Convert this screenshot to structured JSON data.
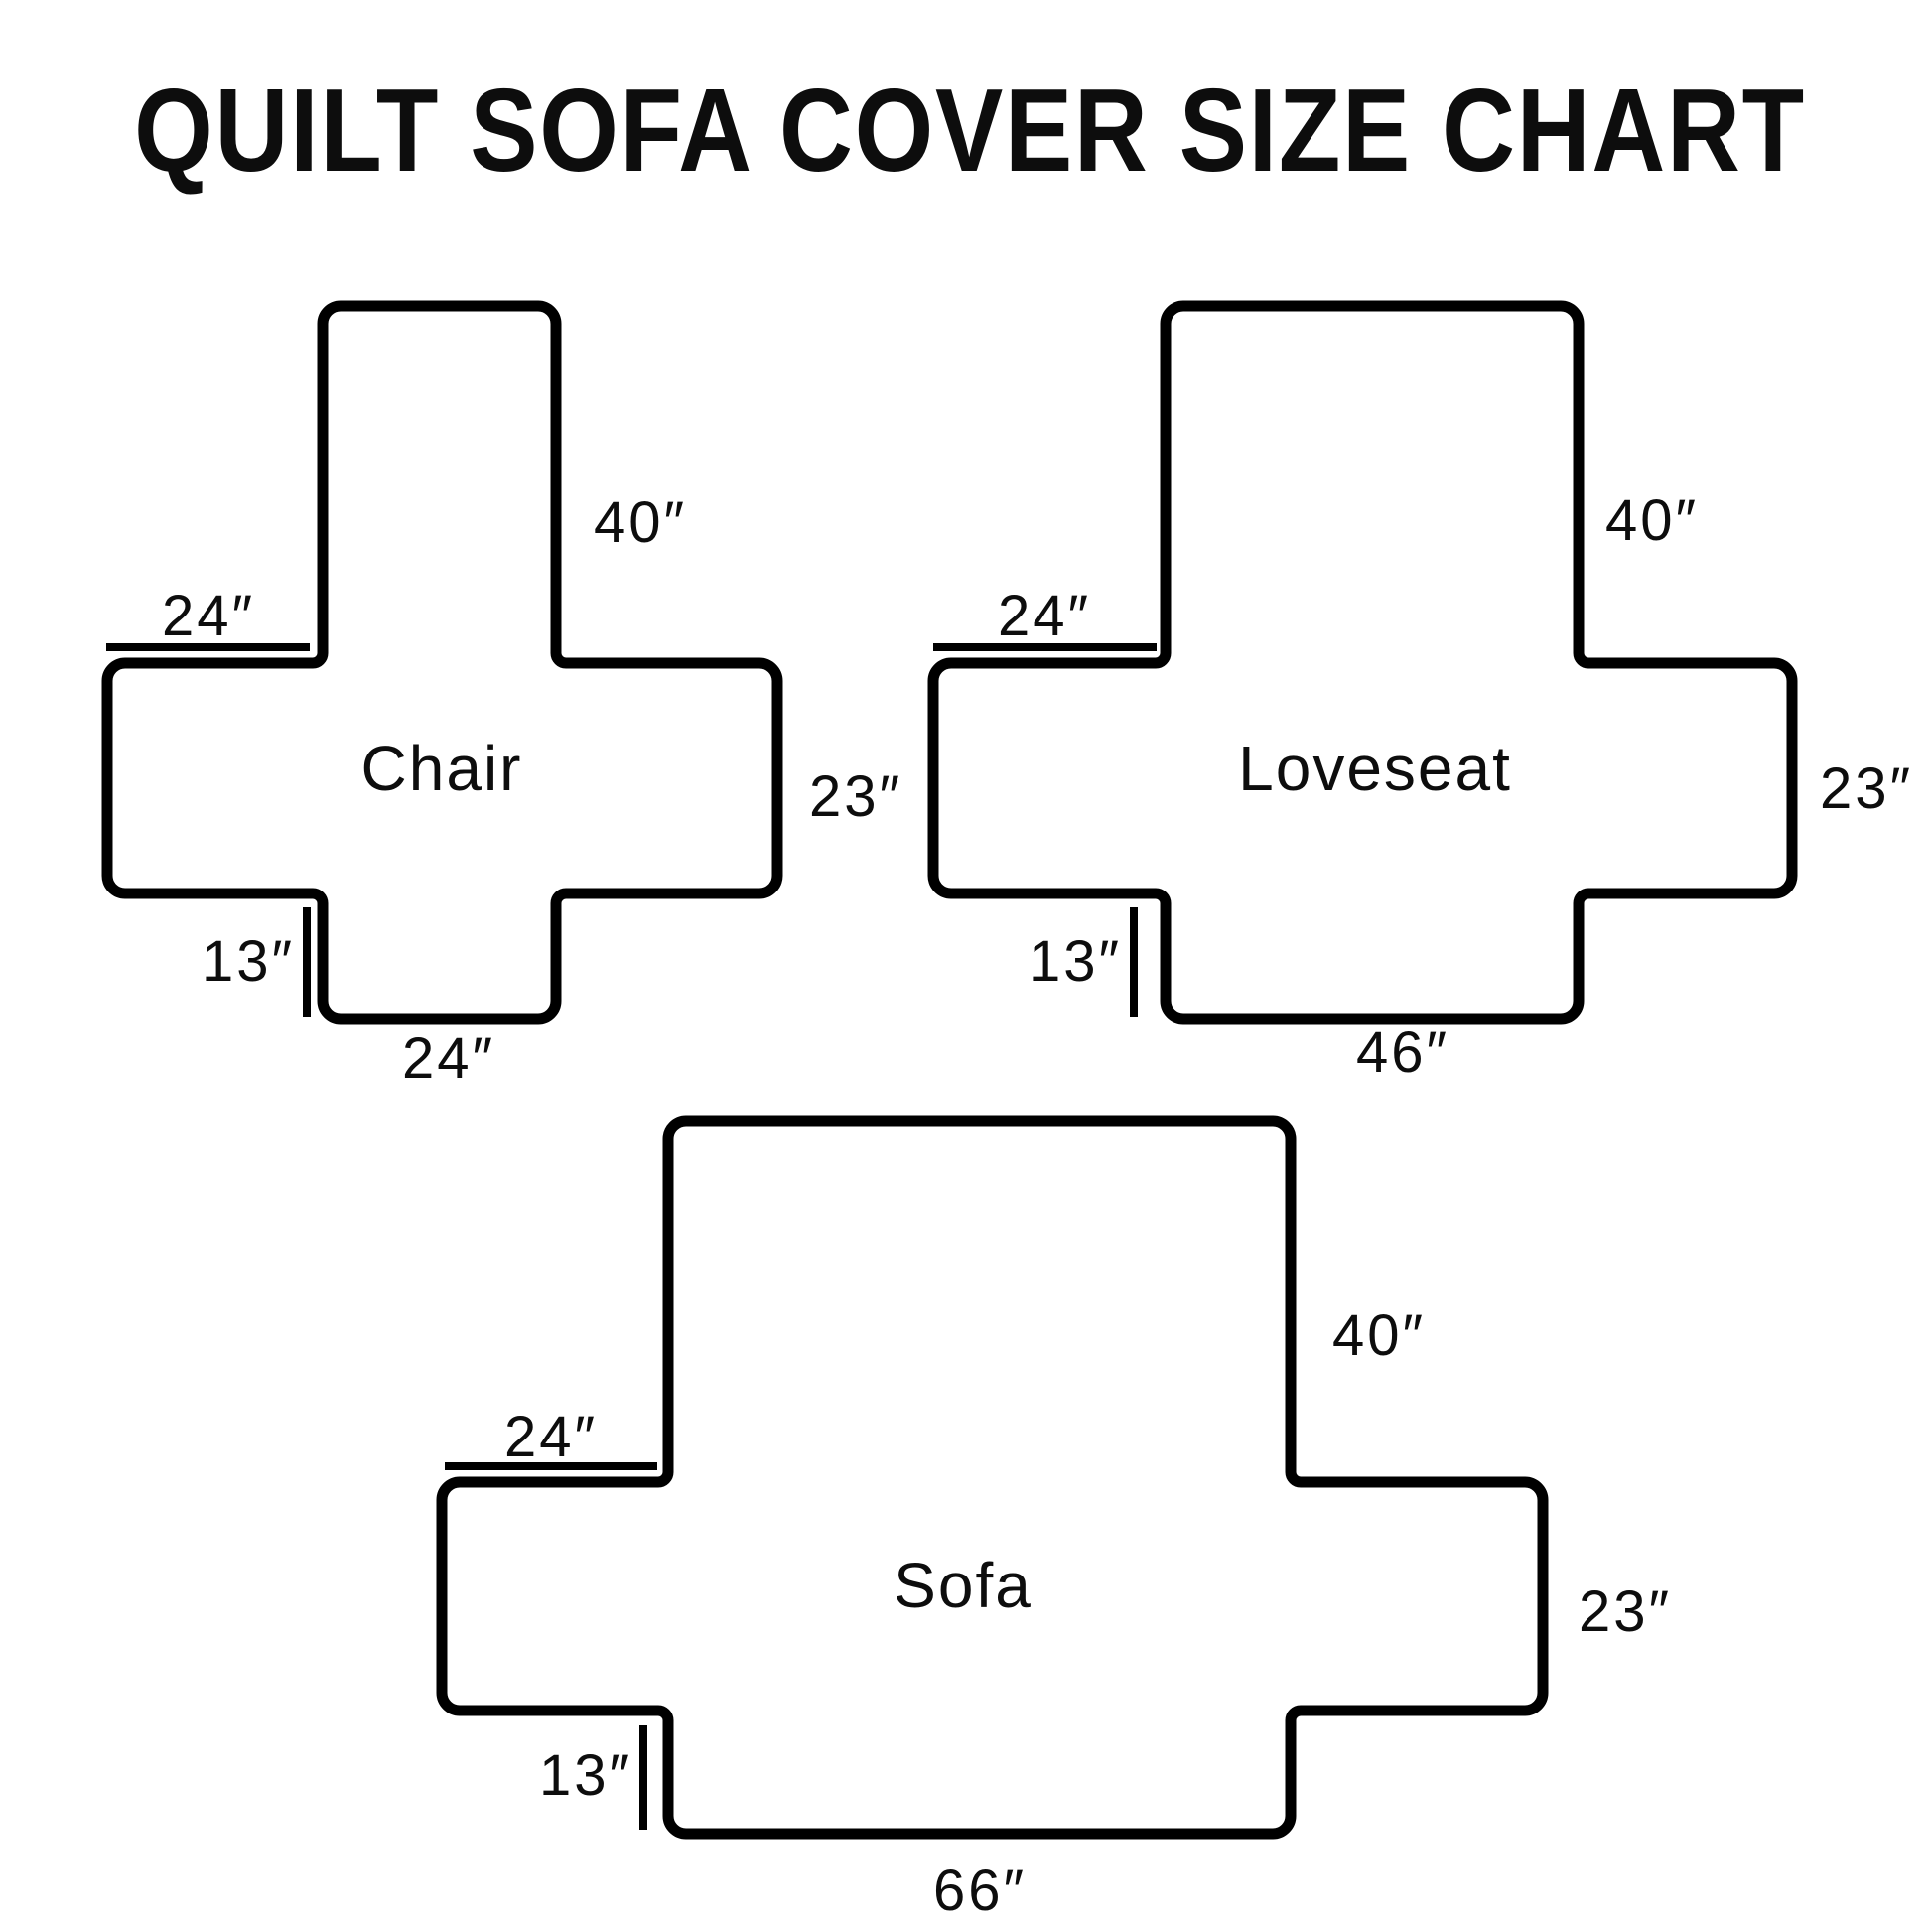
{
  "title": "QUILT SOFA COVER SIZE CHART",
  "colors": {
    "ink": "#000000",
    "paper": "#ffffff"
  },
  "diagrams": [
    {
      "name": "Chair",
      "back_height": "40″",
      "arm_depth": "24″",
      "side_drop": "23″",
      "front_tuck": "13″",
      "front_width": "24″",
      "dimensions_in": {
        "back_height": 40,
        "arm_depth": 24,
        "side_drop": 23,
        "front_tuck": 13,
        "front_width": 24
      }
    },
    {
      "name": "Loveseat",
      "back_height": "40″",
      "arm_depth": "24″",
      "side_drop": "23″",
      "front_tuck": "13″",
      "front_width": "46″",
      "dimensions_in": {
        "back_height": 40,
        "arm_depth": 24,
        "side_drop": 23,
        "front_tuck": 13,
        "front_width": 46
      }
    },
    {
      "name": "Sofa",
      "back_height": "40″",
      "arm_depth": "24″",
      "side_drop": "23″",
      "front_tuck": "13″",
      "front_width": "66″",
      "dimensions_in": {
        "back_height": 40,
        "arm_depth": 24,
        "side_drop": 23,
        "front_tuck": 13,
        "front_width": 66
      }
    }
  ]
}
